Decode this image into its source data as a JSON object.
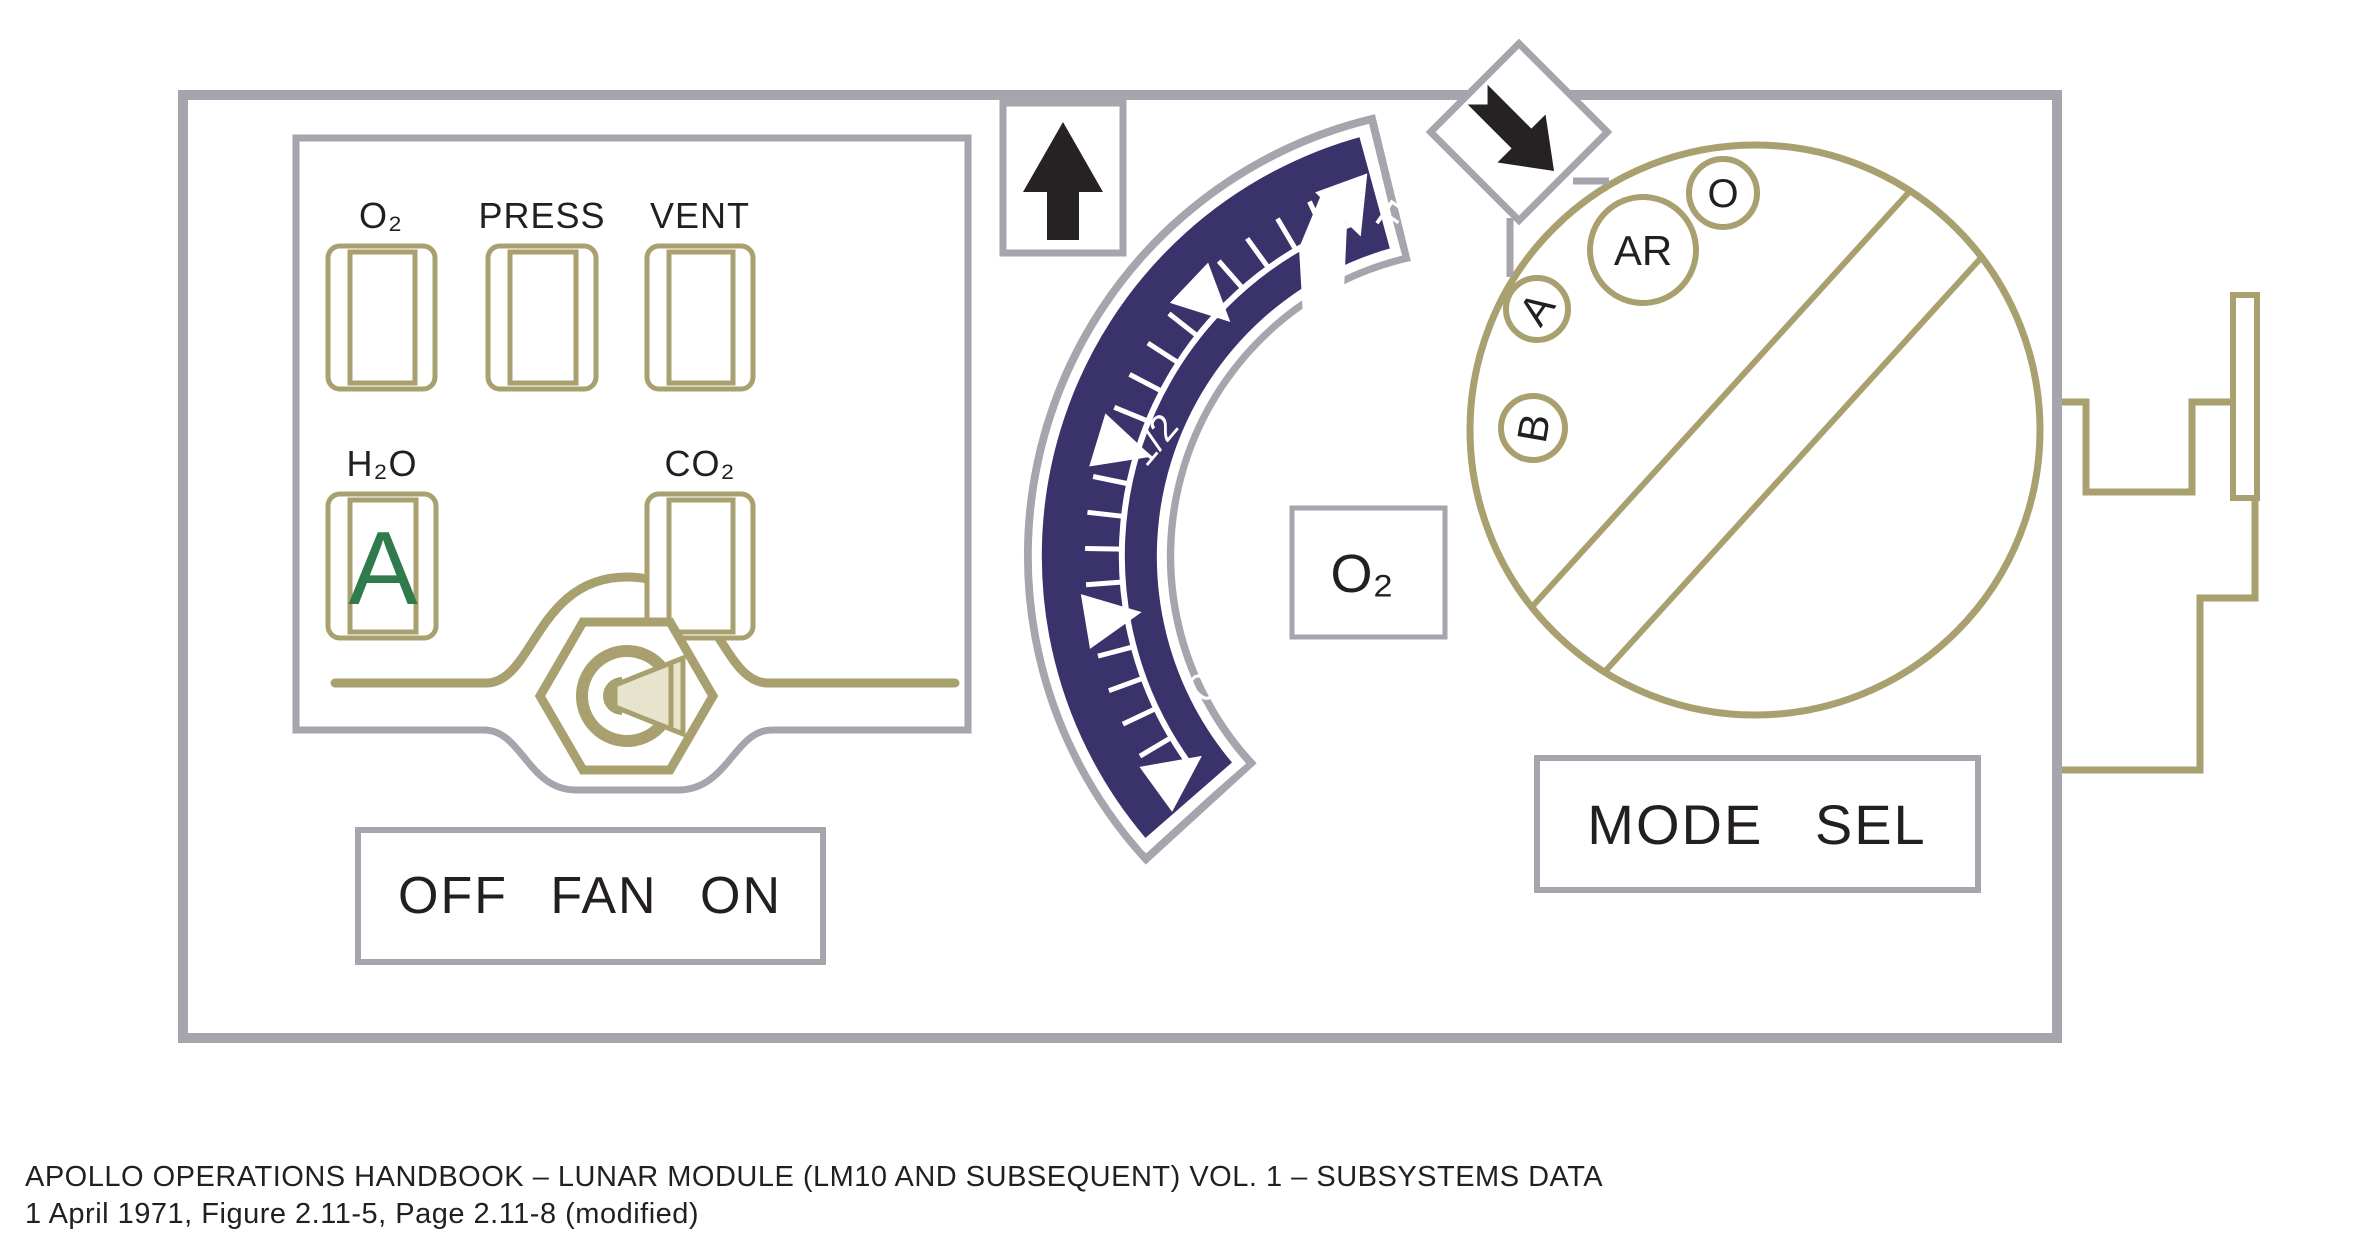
{
  "caption": {
    "line1": "APOLLO OPERATIONS HANDBOOK – LUNAR MODULE (LM10 AND SUBSEQUENT) VOL. 1 – SUBSYSTEMS DATA",
    "line2": "1 April 1971, Figure 2.11-5, Page 2.11-8 (modified)"
  },
  "panel": {
    "indicators": {
      "row1": [
        {
          "label": "O₂"
        },
        {
          "label": "PRESS"
        },
        {
          "label": "VENT"
        }
      ],
      "row2": [
        {
          "label": "H₂O",
          "flag": "A"
        },
        {
          "label": "CO₂"
        }
      ]
    },
    "fan_switch": {
      "label": "OFF FAN ON"
    },
    "icons": {
      "up_arrow": "arrow-up",
      "mode_pointer": "arrow-down-right"
    },
    "gauge": {
      "unit_label": "O₂",
      "center": {
        "x": 1477,
        "y": 556
      },
      "scale_radius": 355,
      "tick_outer_radius": 392,
      "major_angles_deg": [
        20,
        46.5,
        73,
        99.5,
        126
      ],
      "minor_angles_deg": [
        25.3,
        30.6,
        35.9,
        41.2,
        51.8,
        57.1,
        62.4,
        67.7,
        78.3,
        83.6,
        88.9,
        94.2,
        104.8,
        110.1,
        115.4,
        120.7
      ],
      "triangle": {
        "apex_r": 340,
        "base_r": 398,
        "half_angle_deg": 4
      },
      "scale_labels": [
        {
          "text": "F",
          "angle": 16,
          "r": 342,
          "rotate": 35,
          "size": 40
        },
        {
          "text": "1/2",
          "angle": 71,
          "r": 332,
          "rotate": -50,
          "size": 38
        },
        {
          "text": "0",
          "angle": 118,
          "r": 300,
          "rotate": -45,
          "size": 40
        }
      ],
      "needle_points": "1323,190 1347,224 1342,334 1304,334 1299,248"
    },
    "mode_selector": {
      "label": "MODE SEL",
      "positions": [
        "AR",
        "O",
        "A",
        "B"
      ]
    }
  },
  "colors": {
    "panel_border": "#A6A5AD",
    "olive": "#A8A06F",
    "navy": "#39326B",
    "green_flag": "#2F7B4B",
    "arrow_black": "#262223",
    "text": "#231F20",
    "light_khaki": "#E7E3CD"
  }
}
